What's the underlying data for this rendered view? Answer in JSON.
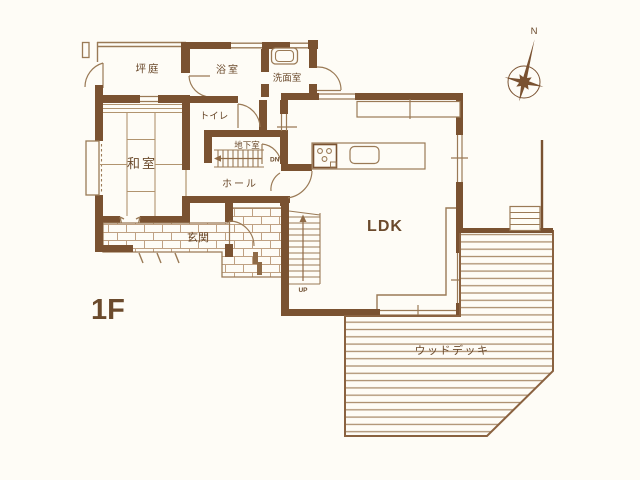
{
  "labels": {
    "floor": "1F",
    "north": "N",
    "up": "UP",
    "down": "DN",
    "rooms": {
      "courtyard": "坪庭",
      "bath": "浴室",
      "washroom": "洗面室",
      "toilet": "トイレ",
      "basement": "地下室",
      "hall": "ホール",
      "washitsu": "和室",
      "entrance": "玄関",
      "ldk": "LDK",
      "wood_deck": "ウッドデッキ"
    }
  },
  "colors": {
    "wall": "#7a5231",
    "thin_line": "#9a7a56",
    "light_line": "#b1946f",
    "brick_line": "#bfa183",
    "deck_line": "#ac8f6f",
    "text": "#6b4a2c",
    "background": "#fefcf6"
  }
}
